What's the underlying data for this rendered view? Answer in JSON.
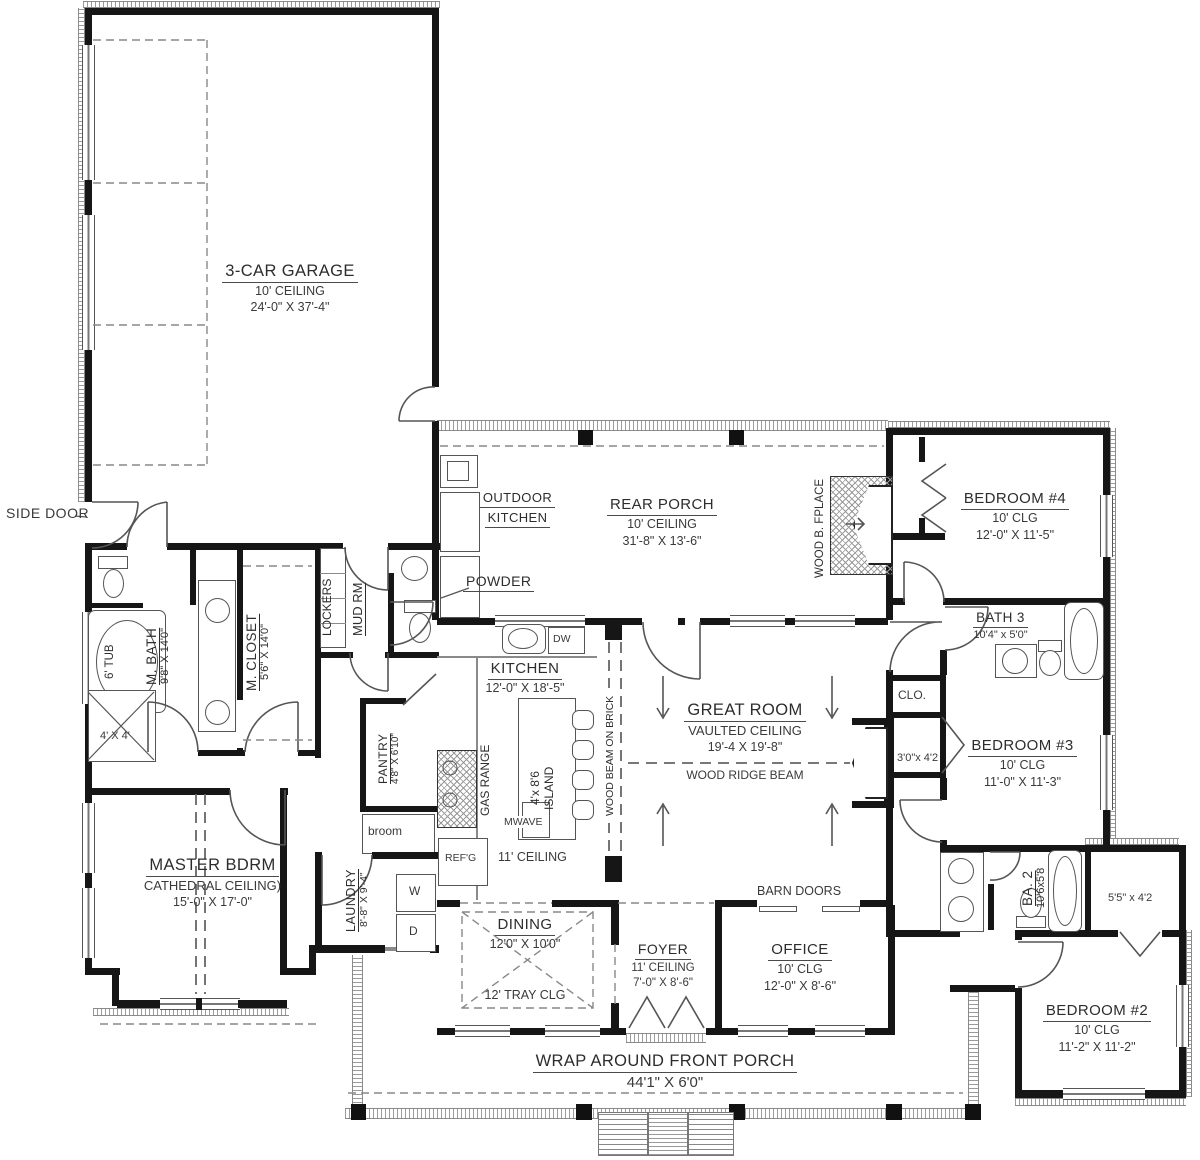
{
  "labels": {
    "garage": {
      "name": "3-CAR GARAGE",
      "ceiling": "10' CEILING",
      "dims": "24'-0\" X 37'-4\""
    },
    "side_door": "SIDE DOOR",
    "rear_porch": {
      "name": "REAR PORCH",
      "ceiling": "10' CEILING",
      "dims": "31'-8\" X 13'-6\""
    },
    "outdoor_kitchen": {
      "line1": "OUTDOOR",
      "line2": "KITCHEN"
    },
    "powder": "POWDER",
    "wood_fireplace": "WOOD B. FPLACE",
    "bedroom4": {
      "name": "BEDROOM #4",
      "ceiling": "10' CLG",
      "dims": "12'-0\" X 11'-5\""
    },
    "bath3": {
      "name": "BATH 3",
      "dims": "10'4\" x 5'0\""
    },
    "clo": "CLO.",
    "clo_small": "3'0\"x 4'2",
    "bedroom3": {
      "name": "BEDROOM #3",
      "ceiling": "10' CLG",
      "dims": "11'-0\" X 11'-3\""
    },
    "ba2": {
      "name": "BA. 2",
      "dims": "10'6x5'8"
    },
    "closet55": "5'5\" x 4'2",
    "bedroom2": {
      "name": "BEDROOM #2",
      "ceiling": "10' CLG",
      "dims": "11'-2\" X 11'-2\""
    },
    "kitchen": {
      "name": "KITCHEN",
      "dims": "12'-0\" X 18'-5\"",
      "ceiling": "11' CEILING"
    },
    "island": {
      "line1": "4'x 8'6",
      "line2": "ISLAND"
    },
    "gas_range": "GAS RANGE",
    "mwave": "MWAVE",
    "refg": "REF'G",
    "dw": "DW",
    "wood_beam": "WOOD BEAM ON BRICK",
    "great_room": {
      "name": "GREAT ROOM",
      "ceiling": "VAULTED CEILING",
      "dims": "19'-4 X 19'-8\"",
      "beam": "WOOD RIDGE BEAM"
    },
    "barn_doors": "BARN DOORS",
    "mbath": {
      "name": "M. BATH",
      "dims": "9'8\" X 14'0\""
    },
    "tub": "6' TUB",
    "shower": "4' X 4'",
    "mcloset": {
      "name": "M. CLOSET",
      "dims": "5'6\" X 14'0\""
    },
    "lockers": "LOCKERS",
    "mudrm": "MUD RM",
    "pantry": {
      "name": "PANTRY",
      "dims": "4'8\" X 6'10\""
    },
    "broom": "broom",
    "laundry": {
      "name": "LAUNDRY",
      "dims": "8'-8\" X 9'-4\"",
      "washer": "W",
      "dryer": "D"
    },
    "master": {
      "name": "MASTER BDRM",
      "ceiling": "CATHEDRAL CEILING)",
      "dims": "15'-0\" X 17'-0\""
    },
    "dining": {
      "name": "DINING",
      "dims": "12'0\" X 10'0\"",
      "ceiling": "12' TRAY CLG"
    },
    "foyer": {
      "name": "FOYER",
      "ceiling": "11' CEILING",
      "dims": "7'-0\" X 8'-6\""
    },
    "office": {
      "name": "OFFICE",
      "ceiling": "10' CLG",
      "dims": "12'-0\" X 8'-6\""
    },
    "front_porch": {
      "name": "WRAP AROUND FRONT PORCH",
      "dims": "44'1\" X 6'0\""
    }
  }
}
